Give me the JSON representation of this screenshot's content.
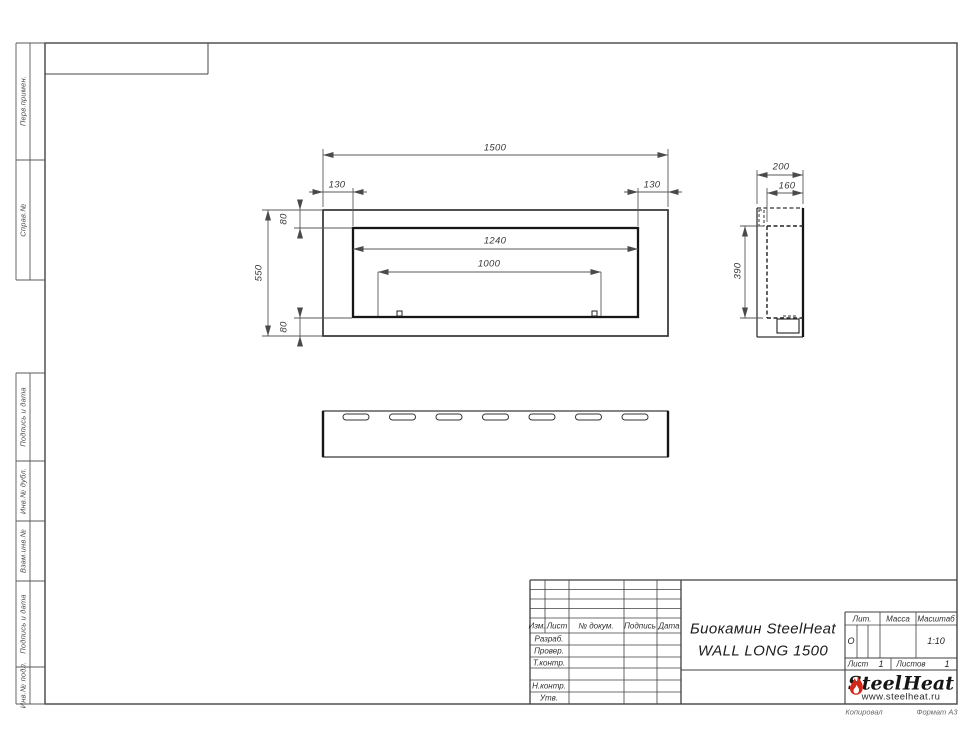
{
  "sheet": {
    "margin_labels": [
      "Перв.примен.",
      "Справ.№",
      "Подпись и дата",
      "Инв.№ дубл.",
      "Взам.инв.№",
      "Подпись и дата",
      "Инв.№ подл."
    ],
    "footer": {
      "copied": "Копировал",
      "format": "Формат А3"
    }
  },
  "drawing": {
    "front_view": {
      "dims": {
        "total_width": "1500",
        "left_frame": "130",
        "right_frame": "130",
        "top_frame": "80",
        "bottom_frame": "80",
        "total_height": "550",
        "opening_width": "1240",
        "burner_width": "1000"
      }
    },
    "side_view": {
      "dims": {
        "total_depth": "200",
        "inner_depth": "160",
        "inner_height": "390"
      }
    }
  },
  "title_block": {
    "header_cols": [
      "Изм.",
      "Лист",
      "№ докум.",
      "Подпись",
      "Дата"
    ],
    "rows": [
      "Разраб.",
      "Провер.",
      "Т.контр.",
      "",
      "Н.контр.",
      "Утв."
    ],
    "title_line1": "Биокамин SteelHeat",
    "title_line2": "WALL LONG 1500",
    "lit_label": "Лит.",
    "lit_value": "О",
    "mass_label": "Масса",
    "scale_label": "Масштаб",
    "scale_value": "1:10",
    "sheet_label": "Лист",
    "sheet_value": "1",
    "sheets_label": "Листов",
    "sheets_value": "1",
    "logo": {
      "part1": "Steel",
      "part2": "Heat",
      "url": "www.steelheat.ru"
    }
  }
}
